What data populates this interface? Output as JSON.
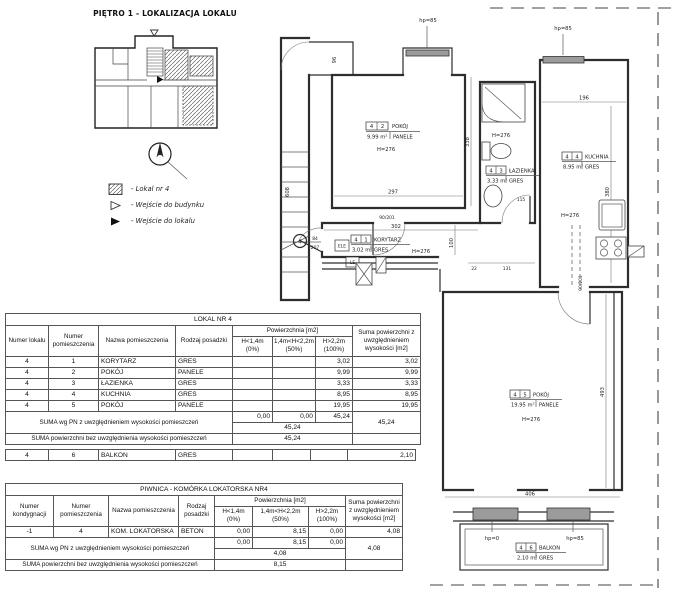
{
  "location_map": {
    "title": "PIĘTRO 1 - LOKALIZACJA LOKALU",
    "legend": [
      {
        "label": "-  Lokal nr 4"
      },
      {
        "label": "-  Wejście do budynku"
      },
      {
        "label": "-  Wejście do lokalu"
      }
    ]
  },
  "plan": {
    "rooms": {
      "korytarz": {
        "unit": "4",
        "no": "1",
        "name": "KORYTARZ",
        "area": "3,02 m²",
        "floor": "GRES",
        "height": "H=276"
      },
      "pokoj2": {
        "unit": "4",
        "no": "2",
        "name": "POKÓJ",
        "area": "9,99 m²",
        "floor": "PANELE",
        "height": "H=276"
      },
      "lazienka": {
        "unit": "4",
        "no": "3",
        "name": "ŁAZIENKA",
        "area": "3,33 m²",
        "floor": "GRES",
        "height": "H=276"
      },
      "kuchnia": {
        "unit": "4",
        "no": "4",
        "name": "KUCHNIA",
        "area": "8,95 m²",
        "floor": "GRES",
        "height": "H=276"
      },
      "pokoj5": {
        "unit": "4",
        "no": "5",
        "name": "POKÓJ",
        "area": "19,95 m²",
        "floor": "PANELE",
        "height": "H=276"
      },
      "balkon": {
        "unit": "4",
        "no": "6",
        "name": "BALKON",
        "area": "2,10 m²",
        "floor": "GRES"
      }
    },
    "dims": {
      "d96": "96",
      "d608": "608",
      "d338": "338",
      "d297": "297",
      "d302": "302",
      "d100": "100",
      "d22": "22",
      "d131": "131",
      "d115": "115",
      "d196": "196",
      "d380": "380",
      "d493": "493",
      "d406": "406"
    },
    "doors": {
      "entrance_w": "84",
      "entrance_h": "207",
      "d90": "90/201"
    },
    "marks": {
      "hp85": "hp=85",
      "hp0": "hp=0",
      "ele": "ELE",
      "le": "LE",
      "entrance_no": "4"
    }
  },
  "table1": {
    "title": "LOKAL NR 4",
    "headers": {
      "col1": "Numer lokalu",
      "col2": "Numer pomieszczenia",
      "col3": "Nazwa pomieszczenia",
      "col4": "Rodzaj posadzki",
      "group": "Powierzchnia [m2]",
      "sub1": "H<1,4m (0%)",
      "sub2": "1,4m<H<2,2m (50%)",
      "sub3": "H>2,2m (100%)",
      "col8": "Suma powierzchni z uwzględnieniem wysokości [m2]"
    },
    "rows": [
      [
        "4",
        "1",
        "KORYTARZ",
        "GRES",
        "",
        "",
        "3,02",
        "3,02"
      ],
      [
        "4",
        "2",
        "POKÓJ",
        "PANELE",
        "",
        "",
        "9,99",
        "9,99"
      ],
      [
        "4",
        "3",
        "ŁAZIENKA",
        "GRES",
        "",
        "",
        "3,33",
        "3,33"
      ],
      [
        "4",
        "4",
        "KUCHNIA",
        "GRES",
        "",
        "",
        "8,95",
        "8,95"
      ],
      [
        "4",
        "5",
        "POKÓJ",
        "PANELE",
        "",
        "",
        "19,95",
        "19,95"
      ]
    ],
    "sum_pn_label": "SUMA wg PN z uwzględnieniem wysokości pomieszczeń",
    "sum_pn_cells": [
      "0,00",
      "0,00",
      "45,24"
    ],
    "sum_pn_merged": "45,24",
    "sum_pn_total": "45,24",
    "sum_flat_label": "SUMA powierzchni bez uwzględnienia wysokości pomieszczeń",
    "sum_flat_value": "45,24",
    "balkon_row": [
      "4",
      "6",
      "BALKON",
      "GRES",
      "",
      "",
      "",
      "2,10"
    ]
  },
  "table2": {
    "title": "PIWNICA - KOMÓRKA LOKATORSKA NR4",
    "headers": {
      "col1": "Numer kondygnacji",
      "col2": "Numer pomieszczenia",
      "col3": "Nazwa pomieszczenia",
      "col4": "Rodzaj posadzki",
      "group": "Powierzchnia [m2]",
      "sub1": "H<1,4m (0%)",
      "sub2": "1,4m<H<2,2m (50%)",
      "sub3": "H>2,2m (100%)",
      "col8": "Suma powierzchni z uwzględnieniem wysokości [m2]"
    },
    "rows": [
      [
        "-1",
        "4",
        "KOM. LOKATORSKA",
        "BETON",
        "0,00",
        "8,15",
        "0,00",
        "4,08"
      ]
    ],
    "sum_pn_label": "SUMA wg PN z uwzględnieniem wysokości pomieszczeń",
    "sum_pn_cells": [
      "0,00",
      "8,15",
      "0,00"
    ],
    "sum_pn_merged": "4,08",
    "sum_pn_total": "4,08",
    "sum_flat_label": "SUMA powierzchni bez uwzględnienia wysokości pomieszczeń",
    "sum_flat_value": "8,15"
  }
}
